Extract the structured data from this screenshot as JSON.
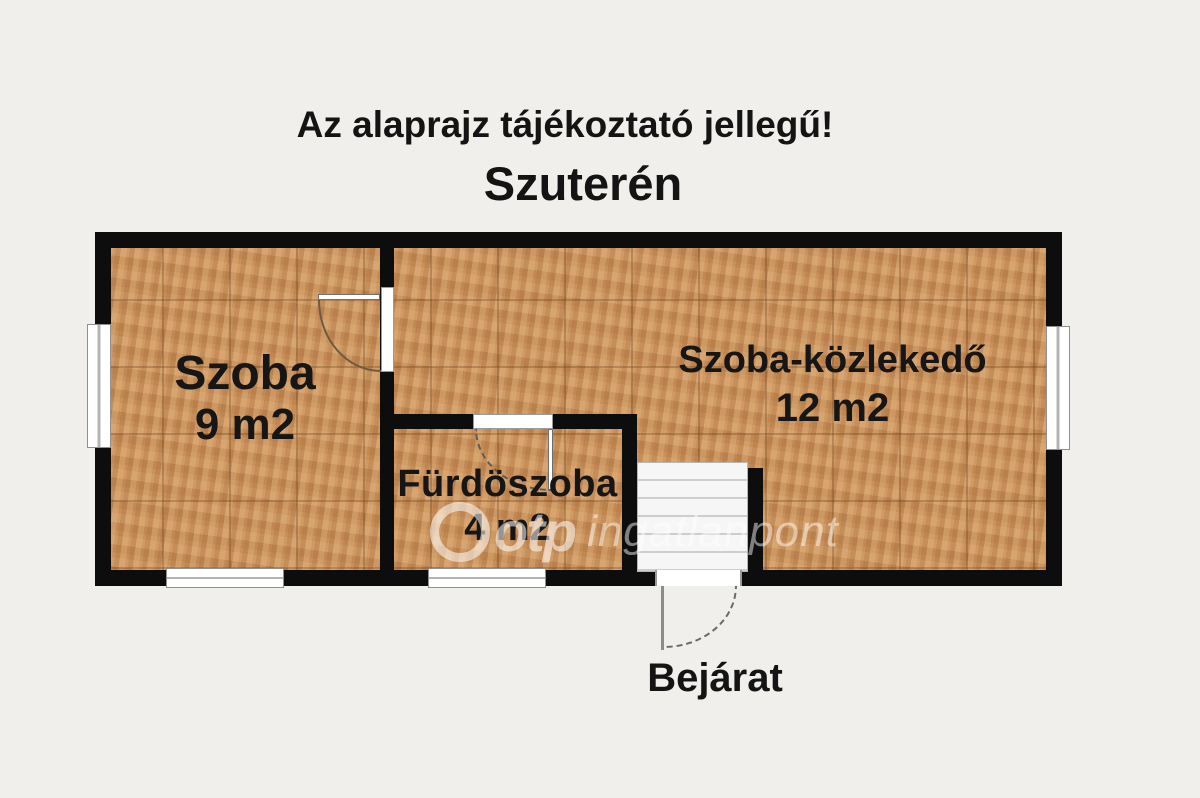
{
  "header": {
    "disclaimer": "Az alaprajz tájékoztató jellegű!",
    "floor_title": "Szuterén"
  },
  "rooms": [
    {
      "name": "Szoba",
      "area": "9 m2"
    },
    {
      "name": "Fürdöszoba",
      "area": "4 m2"
    },
    {
      "name": "Szoba-közlekedő",
      "area": "12 m2"
    }
  ],
  "labels": {
    "entrance": "Bejárat"
  },
  "watermark": {
    "brand": "otp",
    "suffix": "ingatlanpont"
  },
  "colors": {
    "background": "#f0efec",
    "wall": "#0d0d0d",
    "floor_tile": "#c9905a",
    "text": "#141414",
    "window_fill": "#ffffff",
    "watermark": "rgba(255,255,255,0.55)"
  }
}
